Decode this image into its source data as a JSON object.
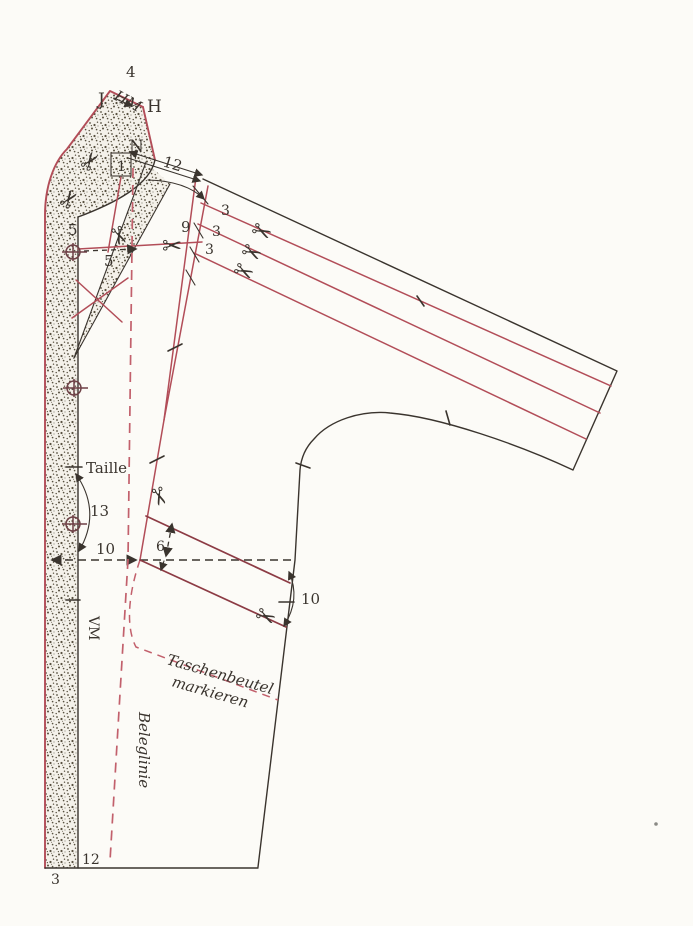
{
  "labels": {
    "four": "4",
    "hm": "HM",
    "j": "J",
    "h": "H",
    "n": "N",
    "one": "1",
    "twelve": "12",
    "nine": "9",
    "three": "3",
    "five": "5",
    "taille": "Taille",
    "thirteen": "13",
    "ten_waist": "10",
    "six": "6",
    "ten_side": "10",
    "vm": "VM",
    "taschenbeutel_line1": "Taschenbeutel",
    "taschenbeutel_line2": "markieren",
    "beleglinie": "Beleglinie",
    "hem_twelve": "12",
    "hem_three": "3"
  },
  "icons": {
    "scissors": "✂"
  },
  "colors": {
    "paper": "#fcfbf7",
    "ink": "#3a342e",
    "red": "#b24d58",
    "red_dark": "#8c3b44",
    "red_dash": "#c2606c",
    "stipple_dot": "#57503f",
    "stipple_bg": "#f4f1ea"
  }
}
